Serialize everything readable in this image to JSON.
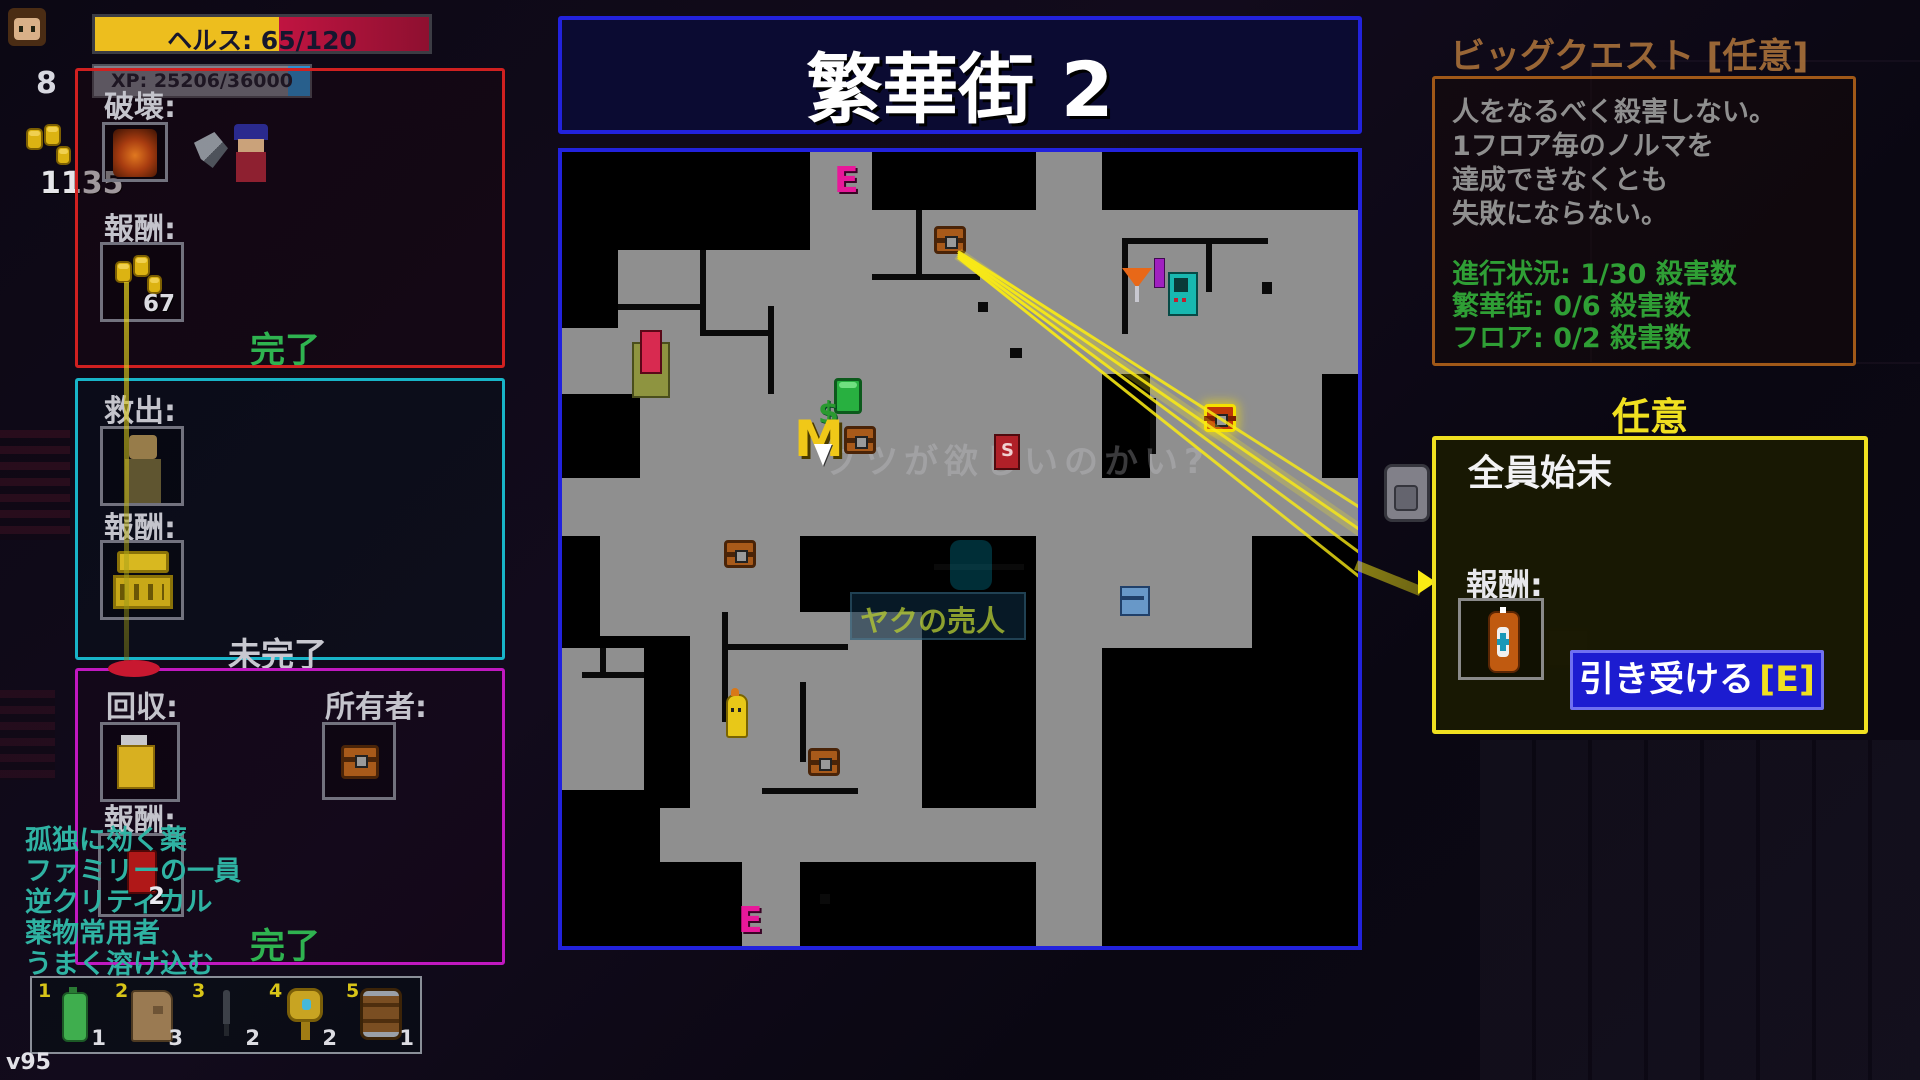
{
  "hud": {
    "health_label": "ヘルス: 65/120",
    "level": "8",
    "xp_label": "XP: 25206/36000",
    "money": "1135",
    "version": "v95"
  },
  "quests": {
    "destroy": {
      "title": "破壊:",
      "reward_label": "報酬:",
      "reward_amount": "67",
      "status": "完了"
    },
    "rescue": {
      "title": "救出:",
      "reward_label": "報酬:",
      "status": "未完了"
    },
    "retrieve": {
      "title": "回収:",
      "owner_label": "所有者:",
      "reward_label": "報酬:",
      "reward_count": "2",
      "status": "完了"
    }
  },
  "traits": [
    "孤独に効く薬",
    "ファミリーの一員",
    "逆クリティカル",
    "薬物常用者",
    "うまく溶け込む"
  ],
  "hotbar": {
    "slots": [
      {
        "num": "1",
        "count": "1",
        "item": "green-canteen"
      },
      {
        "num": "2",
        "count": "3",
        "item": "paper-bag"
      },
      {
        "num": "3",
        "count": "2",
        "item": "knife"
      },
      {
        "num": "4",
        "count": "2",
        "item": "gold-mirror"
      },
      {
        "num": "5",
        "count": "1",
        "item": "barrel"
      }
    ]
  },
  "map": {
    "title": "繁華街 2",
    "markers": {
      "exit_top": "E",
      "exit_bottom": "E",
      "mission": "M",
      "sign_s": "S",
      "money_sign": "$"
    },
    "ghost_dialog": "ブツが欲しいのかい?",
    "ghost_banner": "ヤクの売人"
  },
  "big_quest": {
    "title": "ビッグクエスト [任意]",
    "desc_lines": [
      "人をなるべく殺害しない。",
      "1フロア毎のノルマを",
      "達成できなくとも",
      "失敗にならない。"
    ],
    "progress_lines": [
      "進行状況: 1/30 殺害数",
      "繁華街: 0/6 殺害数",
      "フロア: 0/2 殺害数"
    ]
  },
  "optional_quest": {
    "header": "任意",
    "title": "全員始末",
    "reward_label": "報酬:",
    "accept_label": "引き受ける",
    "accept_key": "[E]"
  },
  "colors": {
    "health_yellow": "#edbe1e",
    "health_red": "#c01441",
    "xp_blue": "#2e8fd0",
    "panel_red": "#d02020",
    "panel_cyan": "#18b4c8",
    "panel_magenta": "#c018c0",
    "map_blue": "#2222dd",
    "quest_orange": "#a05818",
    "optional_yellow": "#f0e020",
    "done_green": "#2fb350",
    "progress_green": "#2f9f35",
    "trait_teal": "#2fb3a3",
    "accept_blue": "#1c1cd0",
    "beam_yellow": "#faeb14"
  }
}
